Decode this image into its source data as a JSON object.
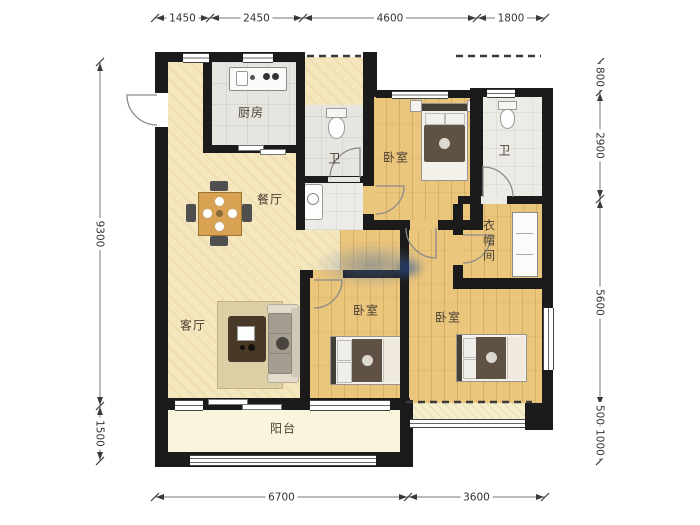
{
  "canvas": {
    "width": 700,
    "height": 525
  },
  "colors": {
    "wall": "#1b1b1b",
    "wood_floor": "#eac57c",
    "tile_floor": "#e6e5e0",
    "cream_floor": "#f4e6bd",
    "balcony_floor": "#f9f4dc",
    "dimension_text": "#333333",
    "watermark_blue": "#4a6ea5"
  },
  "rooms": {
    "kitchen": {
      "label": "厨房"
    },
    "bath_main": {
      "label": "卫"
    },
    "bath_second": {
      "label": "卫"
    },
    "bedroom_north": {
      "label": "卧室"
    },
    "bedroom_middle": {
      "label": "卧室"
    },
    "bedroom_south": {
      "label": "卧室"
    },
    "dining": {
      "label": "餐厅"
    },
    "living": {
      "label": "客厅"
    },
    "cloakroom": {
      "label": "衣帽间"
    },
    "balcony": {
      "label": "阳台"
    }
  },
  "dimensions": {
    "top": {
      "orient": "h",
      "line": 18,
      "ticks": [
        155,
        210,
        303,
        477,
        545
      ],
      "labels": [
        "1450",
        "2450",
        "4600",
        "1800"
      ]
    },
    "bottom": {
      "orient": "h",
      "line": 497,
      "ticks": [
        155,
        408,
        545
      ],
      "labels": [
        "6700",
        "3600"
      ]
    },
    "left": {
      "orient": "v",
      "line": 100,
      "ticks": [
        62,
        406,
        461
      ],
      "labels": [
        "9300",
        "1500"
      ]
    },
    "right": {
      "orient": "v",
      "line": 600,
      "ticks": [
        62,
        92,
        199,
        406,
        424,
        461
      ],
      "labels": [
        "800",
        "2900",
        "5600",
        "500",
        "1000"
      ]
    }
  }
}
